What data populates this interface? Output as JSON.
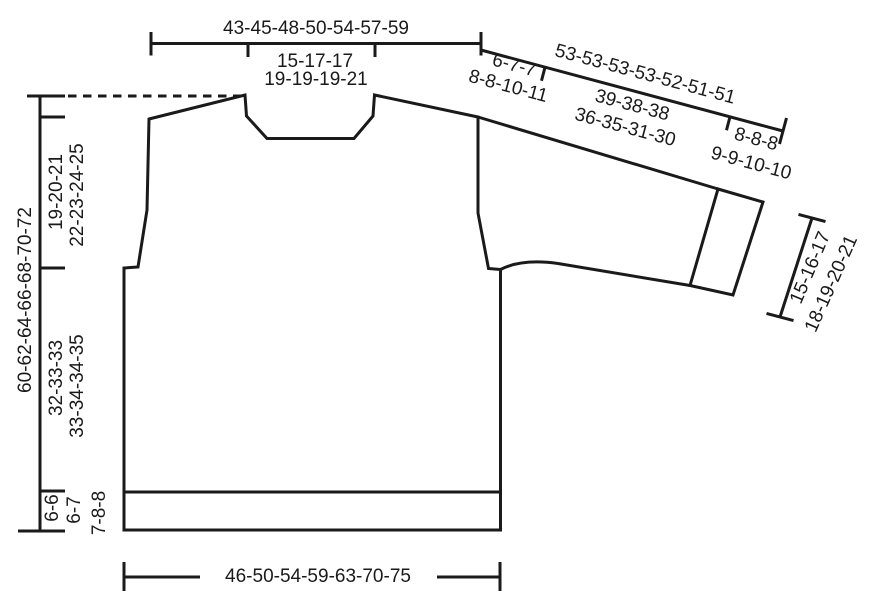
{
  "colors": {
    "line": "#1a1a1a",
    "background": "#ffffff"
  },
  "schematic": {
    "labels": {
      "top_width": "43-45-48-50-54-57-59",
      "neck_width": [
        "15-17-17",
        "19-19-19-21"
      ],
      "sleeve_upper_width": [
        "6-7-7",
        "8-8-10-11"
      ],
      "sleeve_length": "53-53-53-53-52-51-51",
      "sleeve_width": [
        "39-38-38",
        "36-35-31-30"
      ],
      "sleeve_rib": [
        "8-8-8",
        "9-9-10-10"
      ],
      "cuff_width": [
        "15-16-17",
        "18-19-20-21"
      ],
      "total_length": "60-62-64-66-68-70-72",
      "armhole_depth": [
        "19-20-21",
        "22-23-24-25"
      ],
      "side_length": [
        "32-33-33",
        "33-34-34-35"
      ],
      "hem_rib_height": [
        "6-6",
        "6-7",
        "7-8-8"
      ],
      "bottom_width": "46-50-54-59-63-70-75"
    }
  }
}
